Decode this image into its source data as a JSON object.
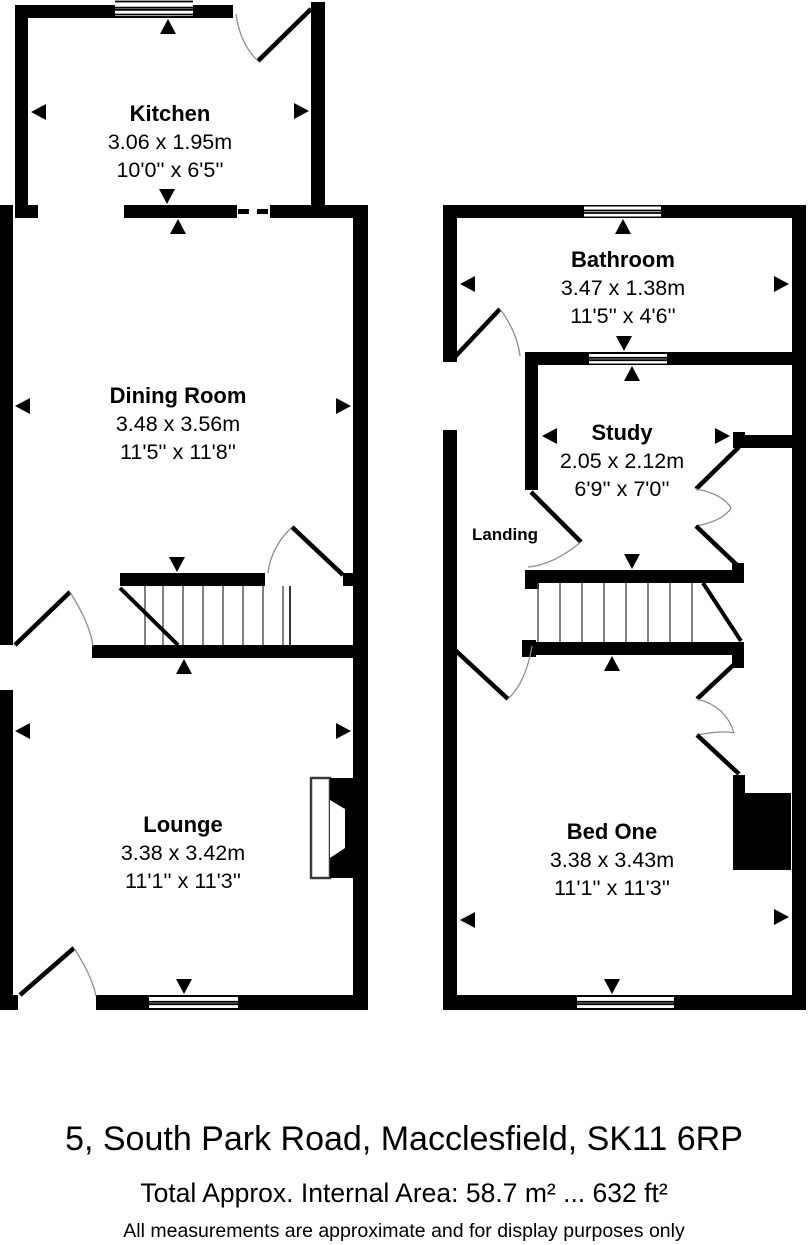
{
  "floorplan": {
    "ground": {
      "rooms": [
        {
          "name": "Kitchen",
          "metric": "3.06 x 1.95m",
          "imperial": "10'0'' x 6'5''"
        },
        {
          "name": "Dining Room",
          "metric": "3.48 x 3.56m",
          "imperial": "11'5'' x 11'8''"
        },
        {
          "name": "Lounge",
          "metric": "3.38 x 3.42m",
          "imperial": "11'1'' x 11'3''"
        }
      ]
    },
    "first": {
      "rooms": [
        {
          "name": "Bathroom",
          "metric": "3.47 x 1.38m",
          "imperial": "11'5'' x 4'6''"
        },
        {
          "name": "Study",
          "metric": "2.05 x 2.12m",
          "imperial": "6'9'' x 7'0''"
        },
        {
          "name": "Bed One",
          "metric": "3.38 x 3.43m",
          "imperial": "11'1'' x 11'3''"
        }
      ],
      "landing_label": "Landing"
    }
  },
  "footer": {
    "address": "5, South Park Road, Macclesfield, SK11 6RP",
    "area_line": "Total Approx. Internal Area: 58.7 m² ... 632 ft²",
    "disclaimer": "All measurements are approximate and for display purposes only"
  },
  "colors": {
    "wall": "#000000",
    "background": "#ffffff",
    "door_arc": "#8f8f8f",
    "stair_tread": "#4d4d4d"
  }
}
